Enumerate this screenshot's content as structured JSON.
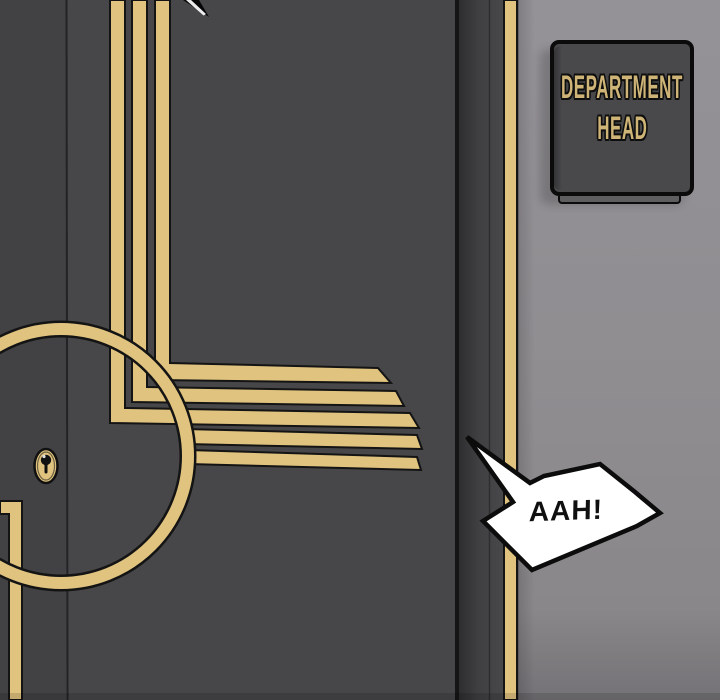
{
  "sign": {
    "line1": "DEPARTMENT",
    "line2": "HEAD"
  },
  "speech_bubble": {
    "text": "AAH!"
  },
  "colors": {
    "door": "#474749",
    "door_left_panel": "#424245",
    "door_seam": "#232325",
    "gold": "#e0c37e",
    "stripe_outline": "#141414",
    "door_edge": "#151515",
    "jamb": "#434346",
    "wall": "#8f8d90",
    "wall_bottom": "#757377",
    "sign_plate": "#49494c",
    "sign_text": "#cfb477",
    "sign_border": "#0b0b0b",
    "bubble_fill": "#ffffff",
    "bubble_border": "#0c0c0c",
    "speech_text_color": "#101010",
    "blade_tip": "#050505"
  }
}
